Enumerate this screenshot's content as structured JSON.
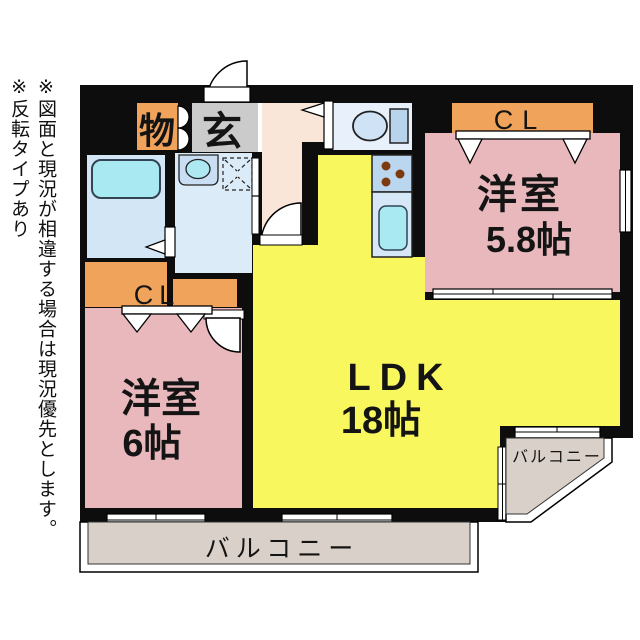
{
  "notes": {
    "note1": "※図面と現況が相違する場合は現況優先とします。",
    "note2": "※反転タイプあり"
  },
  "plan": {
    "storage_label": "物",
    "entrance_label": "玄",
    "closet_top_label": "CL",
    "closet_left_label": "CL",
    "room1_name": "洋室",
    "room1_size": "5.8帖",
    "room2_name": "洋室",
    "room2_size": "6帖",
    "ldk_name": "LDK",
    "ldk_size": "18帖",
    "balcony_bottom_label": "バルコニー",
    "balcony_corner_label": "バルコニー"
  },
  "colors": {
    "wall": "#0d0d0d",
    "room_pink": "#e9b8bc",
    "ldk_yellow": "#f8f75e",
    "closet_orange": "#f0a35b",
    "entrance_gray": "#cbcbcb",
    "hall_beige": "#f9e6d9",
    "bath_blue": "#d3e6f5",
    "washroom_blue": "#dcebf8",
    "toilet_room_blue": "#e8f1fb",
    "kitchen_blue": "#bad7ef",
    "sink_panel_blue": "#d6e8f7",
    "fixture_cyan": "#a9e9f2",
    "balcony_beige": "#d9d0c9",
    "burner_brown": "#7c3a10"
  }
}
